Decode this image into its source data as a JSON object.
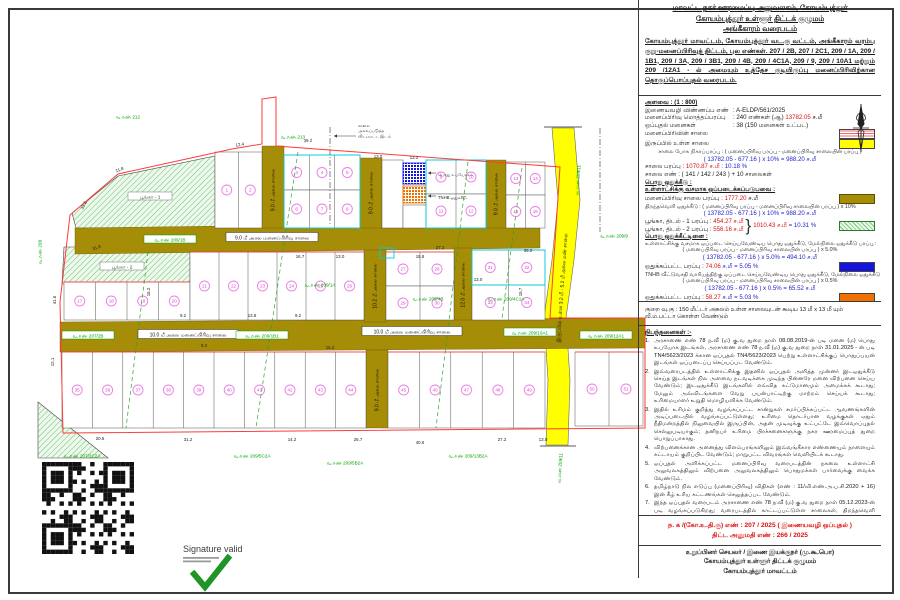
{
  "panel": {
    "title": {
      "line1": "மாவட்ட நகர் ஊரமைப்பு அலுவலகம், கோயம்புத்தூர்",
      "line2": "கோயம்புத்தூர் உள்ளூர் திட்டக் குழுமம்",
      "line3": "அங்கீகாரம் வரைபடம்",
      "body": "கோயம்புத்தூர் மாவட்டம், கோயம்புத்தூர் வட.கு வட்டம், அங்கீகாரம் வரம்பு குறு-மனைப்பிரிவுத் திட்டம், புல எண்கள். 207 / 2B, 207 / 2C1, 209 / 1A, 209 / 1B1, 209 / 3A, 209 / 3B1, 209 / 4B, 209 / 4C1A, 209 / 9, 209 / 10A1 மற்றும் 209 /12A1 - ல் அமையும் உத்தேச குடியிருப்பு மனைப்பிரிவிற்கான தொகுப்பொப்புதல் வரைபடம்."
    },
    "legend": {
      "scale": "அளவை : (1 : 800)",
      "app_label": "இணையவழி விண்ணப்ப எண்",
      "app_value": ": A-ELDP/561/2025",
      "area_label": "மனைப்பிரிவு மொத்தப்பரப்பு",
      "area_value": ": 240 எண்கள் (ஆ)",
      "area_red": "13782.05",
      "area_unit": "ச.மீ",
      "plots_label": "ஒப்புதல் மனைகள்",
      "plots_value": ": 38 (150 மனைகள் உட்பட)",
      "legend_road": "மனைப்பிரிவின் சாலை",
      "legend_exist": "இருப்பில் உள்ள சாலை",
      "net_formula_label": "சாலை போக நிகரப்பரப்பு : ( மனைப்பிரிவு பரப்பு - மனைப்பிரிவு சாலையின் பரப்பு )",
      "net_formula_value": "( 13782.05 - 677.16 ) x 10% = 988.20  ச.மீ",
      "road_area_label": "சாலை பரப்பு :",
      "road_area_red": "1070.87 ச.மீ",
      "road_area_blue": ": 10.18 %",
      "road_num": "சாலை எண் : ( 141 / 142 / 243 ) + 10 சாலைகள்",
      "pub_head1": "பொது ஒதுக்கீடு :",
      "pub_sub1": "உள்ளாட்சிக்கு வசமாக ஒப்படைக்கப்படுபவை :",
      "subroad_label": "மனைப்பிரிவு சாலை பரப்பு",
      "subroad_red": ": 1777.20",
      "subroad_unit": "ச.மீ",
      "open_calc_label": "திறந்தவெளி ஒதுக்கீடு : ( மனைப்பிரிவு பரப்பு - மனைப்பிரிவு சாலையின் பரப்பு ) x 10%",
      "open_calc_value": "( 13782.05 - 677.16 ) x 10% = 988.20  ச.மீ",
      "park1_label": "பூங்கா, திடல் - 1 பரப்பு :",
      "park1_red": "454.27 ச.மீ",
      "park2_label": "பூங்கா, திடல் - 2 பரப்பு :",
      "park2_red": "556.16 ச.மீ",
      "park_total_red": "1010.43 ச.மீ",
      "park_total_blue": "= 10.31 %",
      "pub_head2": "பொது ஒதுக்கீட்டினை :",
      "pub_sub2": "உள்ளாட்சிக்கு வசமாக ஒப்படை செய்யவேண்டிய பொது ஒதுக்கீடு, மேல்நிலை ஒதுக்கீடு பரப்பு :",
      "calc2_label": "( மனைப்பிரிவு பரப்பு - மனைப்பிரிவு சாலையின் பரப்பு ) x 5.0%",
      "calc2_value": "( 13782.05 - 677.16 ) x 5.0% = 494.10  ச.மீ",
      "handover_label": "ஒதுக்கப்பட்ட பரப்பு :",
      "handover_red": "74.06",
      "handover_blue": "ச.மீ = 5.05 %",
      "tnhb_sub": "TNHB வீட்டுவசதி வாரியத்திற்கு ஒப்படை செய்யவேண்டிய பொது ஒதுக்கீடு, மேல்நிலை ஒதுக்கீடு பரப்பு :",
      "calc3_label": "( மனைப்பிரிவு பரப்பு - மனைப்பிரிவு சாலையின் பரப்பு ) x 0.5%",
      "calc3_value": "( 13782.05 - 677.16 ) x 0.5% = 65.52  ச.மீ",
      "tnhb_label": "ஒதுக்கப்பட்ட பரப்பு :",
      "tnhb_red": "58.27",
      "tnhb_blue": "ச.மீ = 5.03 %"
    },
    "note": "குறை வு.கு : 150 மீட்டர் அகலம் உள்ள சாலையுடன் கூடிய 13 மீ x 13 மீ யும் வீ.ம.பட்டா கொள்ள வேண்டும்",
    "conditions": {
      "heading": "நிபந்தனைகள் :-",
      "items": [
        {
          "n": "1.",
          "text": "அரசாணை எண் 78 ந.வீ (ம) கு.வ துறை நாள் 08.08.2019-ன் படி மனை (ம) பொது உபயோக இடங்கள், அரசாணை எண் 78 ந.வீ (ம) கு.வ துறை நாள் 31.01.2025 - ன் படி TN4/5623/2023 க்கான ஒப்புதல் TN4/5623/2023 பெற்று உள்ளாட்சிக்குப் பொதுப்பயன் இடங்கள் ஒப்படைப்பு செய்யப்பட வேண்டும்."
        },
        {
          "n": "2.",
          "text": "இவ்வரைபடத்தில் உள்ளாட்சிக்கு இதனில் ஒப்புதல் அளித்த முன்னர் இடஒதுக்கீடு செய்த இடங்கள் நில அளவை நடவடிக்கை முடிந்த பின்னரே மனை விற்பனை செய்ய வேண்டும்; இடஒதுக்கீடு இடங்களில் எவ்வித கட்டுமானமும் அமைக்கக் கூடாது; மேலும் அவ்விடங்களை வேறு பயன்பாட்டிற்கு மாற்றம் செய்யக் கூடாது; உரிமையாளர் உறுதி மொழியளிக்க வேண்டும்."
        },
        {
          "n": "3.",
          "text": "இதில் உரிமம் குறித்து வழங்கப்பட்ட சான்றுகள் சமர்ப்பிக்கப்பட்ட ஆவணங்களின் அடிப்படையில் வழங்கப்பட்டுள்ளது; உரிமை தொடர்பான வழக்குகள் ஏதும் நீதிமன்றத்தில் நிலுவையில் இருப்பின், அதன் முடிவுக்கு உட்பட்டே இவ்வொப்புதல் செல்லுபடியாகும்; தனிநபர் உரிமை பிரச்சனைகளுக்கு நகர ஊரமைப்புத் துறை பொறுப்பாகாது."
        },
        {
          "n": "4.",
          "text": "விற்பனைக்கான அனைத்து விளம்பரங்களிலும் இவ்வங்கீகார எண்ணையும் நாளையும் கட்டாயம் குறிப்பிட வேண்டும்; மாறுபட்ட விவரங்கள் வெளியிடக் கூடாது."
        },
        {
          "n": "5.",
          "text": "ஒப்புதல் அளிக்கப்பட்ட மனைப்பிரிவு வரைபடத்தின் நகலை உள்ளாட்சி அலுவலகத்திலும் விற்பனை அலுவலகத்திலும் பொதுமக்கள் பார்வைக்கு வைக்க வேண்டும்."
        },
        {
          "n": "6.",
          "text": "தமிழ்நாடு நில எடுப்பு (மனைப்பிரிவு) விதிகள் (எண் : 11/வி.எண்.அ.ப.சி.2020 + 16) இன் கீழ் உரிய கட்டணங்கள் செலுத்தப்பட வேண்டும்."
        },
        {
          "n": "7.",
          "text": "இந்த ஒப்புதல் வரைபடம் அரசாணை எண் 78 ந.வீ (ம) கு.வ துறை நாள் 05.12.2023-ன் படி வழங்கப்படுகிறது; வரைபடத்தில் காட்டப்பட்டுள்ள சாலைகள், திறந்தவெளி இடங்கள் ஆகியவற்றை உரிய முறையில் பராமரித்து உள்ளாட்சிக்கு இலவசமாக ஒப்படைக்க வேண்டும்."
        }
      ]
    },
    "reference": {
      "line1": "ந. க /(கோ.உ.தி.கு) எண் : 207 / 2025 ( இணையவழி ஒப்புதல் )",
      "line2": "திட்ட அனுமதி எண் : 266 / 2025"
    },
    "signatory": {
      "line1": "உறுப்பினர் செயலர் / இணை இயக்குநர் (மு.கூ.பொ)",
      "line2": "கோயம்புத்தூர் உள்ளூர் திட்டக் குழுமம்",
      "line3": "கோயம்புத்தூர் மாவட்டம்"
    }
  },
  "signature": {
    "label": "Signature valid"
  },
  "map": {
    "colors": {
      "road": "#a58d07",
      "existing_road": "#ffff00",
      "boundary": "#ff3b3b",
      "plot_line": "#555555",
      "circle": "#ee7ce6",
      "circle_text": "#c94fc0",
      "survey_green": "#00a000",
      "cyan": "#00cfe0",
      "public_blue": "#1414dd",
      "tnhb_orange": "#f07000"
    },
    "boundary_path": "M63,433 L60,302 L70,215 L118,174 L232,149 L262,144 L262,99 L276,97 L276,146 L560,167 L550,318 L645,318 L645,428 L63,433 Z",
    "yellow_road_path": "M552,128 L574,128 L580,200 L574,260 L566,318 L570,380 L568,445 L546,445 L548,380 L544,318 L552,260 L558,200 Z",
    "road_polys": [
      "75,228 540,222 540,248 75,254",
      "60,322 645,318 645,348 60,352"
    ],
    "road_rects": [
      [
        262,
        146,
        22,
        82
      ],
      [
        360,
        158,
        22,
        70
      ],
      [
        364,
        250,
        22,
        72
      ],
      [
        366,
        350,
        22,
        78
      ],
      [
        454,
        248,
        18,
        72
      ],
      [
        486,
        160,
        20,
        68
      ]
    ],
    "parks": [
      {
        "pts": "72,213 118,176 215,156 215,228 76,228",
        "label": "பூங்கா - 1",
        "lx": 150,
        "ly": 197
      },
      {
        "pts": "64,247 190,247 190,282 62,284",
        "label": "பூங்கா - 2",
        "lx": 122,
        "ly": 267
      },
      {
        "pts": "38,402 108,458 38,458",
        "label": "",
        "lx": 0,
        "ly": 0
      }
    ],
    "strips": [
      [
        215,
        152,
        262,
        228,
        2,
        1,
        0
      ],
      [
        284,
        155,
        360,
        190,
        3,
        1,
        0
      ],
      [
        284,
        190,
        360,
        228,
        3,
        1,
        0
      ],
      [
        382,
        160,
        403,
        228,
        1,
        0,
        0
      ],
      [
        403,
        205,
        426,
        228,
        1,
        0,
        0
      ],
      [
        426,
        160,
        486,
        194,
        2,
        1,
        0
      ],
      [
        426,
        194,
        486,
        228,
        2,
        1,
        0
      ],
      [
        506,
        162,
        545,
        195,
        2,
        1,
        0
      ],
      [
        506,
        195,
        545,
        228,
        2,
        1,
        0
      ],
      [
        64,
        282,
        190,
        320,
        4,
        1,
        1
      ],
      [
        190,
        252,
        364,
        320,
        6,
        1,
        1
      ],
      [
        386,
        252,
        454,
        286,
        2,
        1,
        1
      ],
      [
        386,
        286,
        454,
        320,
        2,
        1,
        0
      ],
      [
        472,
        250,
        545,
        285,
        2,
        1,
        1
      ],
      [
        472,
        285,
        545,
        320,
        2,
        1,
        0
      ],
      [
        62,
        352,
        366,
        428,
        10,
        1,
        1
      ],
      [
        388,
        352,
        545,
        428,
        5,
        1,
        1
      ],
      [
        575,
        352,
        643,
        426,
        2,
        1,
        1
      ]
    ],
    "specials": [
      {
        "x": 403,
        "y": 163,
        "w": 23,
        "h": 21,
        "kind": "blue"
      },
      {
        "x": 403,
        "y": 186,
        "w": 23,
        "h": 17,
        "kind": "orange"
      }
    ],
    "cyan_rects": [
      [
        284,
        155,
        76,
        73
      ],
      [
        426,
        160,
        60,
        68
      ],
      [
        472,
        250,
        73,
        35
      ],
      [
        380,
        248,
        14,
        10
      ]
    ],
    "green_dashed": [
      [
        298,
        152,
        256,
        428
      ],
      [
        468,
        162,
        436,
        428
      ],
      [
        148,
        252,
        126,
        428
      ],
      [
        522,
        168,
        502,
        318
      ]
    ],
    "dashdot": [
      [
        330,
        127,
        330,
        225
      ],
      [
        600,
        128,
        600,
        232
      ]
    ],
    "road_labels": [
      {
        "t": "9.0 மீ அகல மனைப்பிரிவு சாலை",
        "x": 272,
        "y": 238,
        "w": 92,
        "rot": 0,
        "box": 1
      },
      {
        "t": "10.0 மீ அகல மனைப்பிரிவு சாலை",
        "x": 188,
        "y": 335,
        "w": 100,
        "rot": 0,
        "box": 1
      },
      {
        "t": "10.0 மீ அகல மனைப்பிரிவு சாலை",
        "x": 412,
        "y": 332,
        "w": 100,
        "rot": 0,
        "box": 1
      },
      {
        "t": "9.0 மீ அகல சாலை",
        "x": 273,
        "y": 190,
        "w": 0,
        "rot": -90,
        "box": 0
      },
      {
        "t": "9.0 மீ அகல சாலை",
        "x": 371,
        "y": 193,
        "w": 0,
        "rot": -90,
        "box": 0
      },
      {
        "t": "10.2 மீ அகல சாலை",
        "x": 375,
        "y": 286,
        "w": 0,
        "rot": -90,
        "box": 0
      },
      {
        "t": "9.0 மீ அகல சாலை",
        "x": 377,
        "y": 390,
        "w": 0,
        "rot": -90,
        "box": 0
      },
      {
        "t": "12.0 மீ அகல சாலை",
        "x": 463,
        "y": 285,
        "w": 0,
        "rot": -90,
        "box": 0
      },
      {
        "t": "9.0 மீ அகல சாலை",
        "x": 496,
        "y": 194,
        "w": 0,
        "rot": -90,
        "box": 0
      },
      {
        "t": "இருப்பில் உள்ள 3.2 மீ - 5.2 மீ அகல மண் சாலை",
        "x": 562,
        "y": 288,
        "w": 0,
        "rot": -86,
        "box": 0
      }
    ],
    "survey_labels": [
      {
        "t": "வ.எண் 212",
        "x": 128,
        "y": 117,
        "rot": 0,
        "box": 0
      },
      {
        "t": "வ.எண் 213",
        "x": 293,
        "y": 137,
        "rot": 0,
        "box": 0
      },
      {
        "t": "வ.எண் 209/1B",
        "x": 170,
        "y": 240,
        "rot": 0,
        "box": 1
      },
      {
        "t": "வ.எண் 209/9",
        "x": 614,
        "y": 236,
        "rot": 0,
        "box": 0
      },
      {
        "t": "வ.எண் 208",
        "x": 40,
        "y": 252,
        "rot": -90,
        "box": 0
      },
      {
        "t": "வ.எண் 207/2B",
        "x": 88,
        "y": 336,
        "rot": 0,
        "box": 1
      },
      {
        "t": "வ.எண் 209/1B1",
        "x": 262,
        "y": 336,
        "rot": 0,
        "box": 1
      },
      {
        "t": "வ.எண் 209/10A1",
        "x": 530,
        "y": 333,
        "rot": 0,
        "box": 1
      },
      {
        "t": "வ.எண் 209/12A1",
        "x": 606,
        "y": 336,
        "rot": 0,
        "box": 1
      },
      {
        "t": "வ.எண் 209/1A",
        "x": 320,
        "y": 285,
        "rot": 0,
        "box": 0
      },
      {
        "t": "வ.எண் 209/4B",
        "x": 428,
        "y": 299,
        "rot": 0,
        "box": 0
      },
      {
        "t": "வ.எண் 209/4C1A",
        "x": 506,
        "y": 299,
        "rot": 0,
        "box": 0
      },
      {
        "t": "வ.எண் 207/2C2A",
        "x": 82,
        "y": 456,
        "rot": 0,
        "box": 0
      },
      {
        "t": "வ.எண் 209/5C2A",
        "x": 252,
        "y": 456,
        "rot": 0,
        "box": 0
      },
      {
        "t": "வ.எண் 209/5B2A",
        "x": 345,
        "y": 463,
        "rot": 0,
        "box": 0
      },
      {
        "t": "வ.எண் 209/13B2A",
        "x": 468,
        "y": 456,
        "rot": 0,
        "box": 0
      },
      {
        "t": "வ.எண் 209/11",
        "x": 560,
        "y": 468,
        "rot": -86,
        "box": 0
      },
      {
        "t": "வ.எண் 209/11",
        "x": 578,
        "y": 180,
        "rot": -86,
        "box": 0
      }
    ],
    "dims": [
      [
        "12.4",
        240,
        146,
        -8
      ],
      [
        "39.2",
        308,
        142,
        -4
      ],
      [
        "13.0",
        378,
        158,
        0
      ],
      [
        "11.8",
        120,
        171,
        -20
      ],
      [
        "33.8",
        85,
        206,
        -62
      ],
      [
        "31.8",
        97,
        249,
        -18
      ],
      [
        "41.6",
        56,
        300,
        -90
      ],
      [
        "12.1",
        54,
        362,
        -90
      ],
      [
        "20.5",
        100,
        440,
        0
      ],
      [
        "31.2",
        188,
        441,
        0
      ],
      [
        "14.2",
        292,
        441,
        0
      ],
      [
        "26.7",
        358,
        441,
        0
      ],
      [
        "40.6",
        420,
        444,
        0
      ],
      [
        "27.2",
        502,
        441,
        0
      ],
      [
        "13.0",
        543,
        441,
        0
      ],
      [
        "16.7",
        300,
        258,
        0
      ],
      [
        "15.2",
        150,
        292,
        -90
      ],
      [
        "9.2",
        183,
        317,
        0
      ],
      [
        "13.8",
        252,
        317,
        0
      ],
      [
        "15.8",
        420,
        258,
        0
      ],
      [
        "27.2",
        440,
        249,
        0
      ],
      [
        "35.0",
        528,
        252,
        0
      ],
      [
        "15.7",
        522,
        292,
        -90
      ],
      [
        "13.0",
        478,
        281,
        0
      ],
      [
        "13.2",
        414,
        159,
        0
      ],
      [
        "9.2",
        298,
        317,
        0
      ],
      [
        "13.0",
        340,
        258,
        0
      ],
      [
        "9.2",
        204,
        347,
        0
      ],
      [
        "16.2",
        330,
        349,
        0
      ]
    ],
    "leaders": [
      {
        "lines": [
          "சாலை",
          "அகலப்படுத்த",
          "விடப்பட்ட இடம்"
        ],
        "x": 358,
        "y": 127,
        "ax1": 356,
        "ay1": 136,
        "ax2": 334,
        "ay2": 136
      },
      {
        "lines": [
          "பொது உபயோகம்"
        ],
        "x": 438,
        "y": 176,
        "ax1": 436,
        "ay1": 173,
        "ax2": 428,
        "ay2": 173
      },
      {
        "lines": [
          "TNHB ஒதுக்கீடு"
        ],
        "x": 438,
        "y": 199,
        "ax1": 436,
        "ay1": 196,
        "ax2": 428,
        "ay2": 196
      }
    ]
  }
}
